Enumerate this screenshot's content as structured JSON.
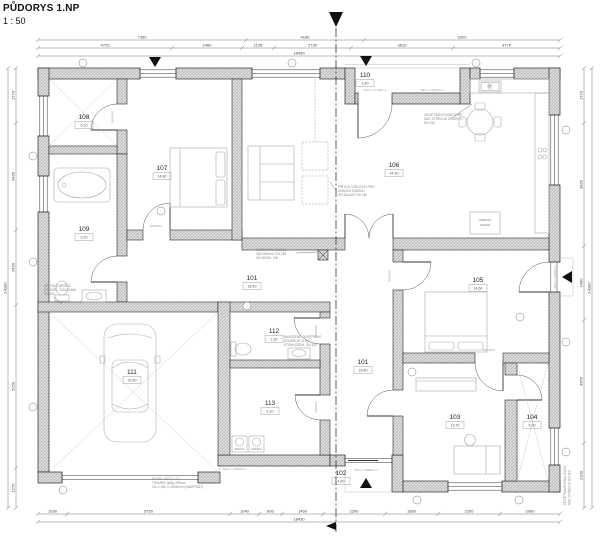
{
  "sheet": {
    "title": "PŮDORYS 1.NP",
    "scale": "1 : 50"
  },
  "rooms": [
    {
      "number": "101",
      "area": "18,40"
    },
    {
      "number": "102",
      "area": "4,60"
    },
    {
      "number": "103",
      "area": "13,70"
    },
    {
      "number": "104",
      "area": "4,20"
    },
    {
      "number": "105",
      "area": "14,60"
    },
    {
      "number": "106",
      "area": "44,30"
    },
    {
      "number": "107",
      "area": "14,80"
    },
    {
      "number": "108",
      "area": "5,10"
    },
    {
      "number": "109",
      "area": "9,20"
    },
    {
      "number": "110",
      "area": "3,40"
    },
    {
      "number": "111",
      "area": "22,60"
    },
    {
      "number": "112",
      "area": "2,30"
    },
    {
      "number": "113",
      "area": "6,10"
    }
  ],
  "appliances": {
    "fridge_line1": "AMERICKÁ",
    "fridge_line2": "LEDNICE",
    "washer": "PRAČKA",
    "dryer": "SUŠIČKA"
  },
  "notes": {
    "hood": [
      "ODVĚTRÁNÍ DIGESTOŘE",
      "NAD STŘECHU OBJEKTU",
      "DN 150"
    ],
    "stove_air": [
      "PŘÍVOD VZDUCHU PRO",
      "KRBOVÁ KAMNA /",
      "INSTALACE DN 150"
    ],
    "chimney": [
      "KOMÍNOVÉ TĚLESO",
      "360x360mm, DN 180",
      "SCHIEDEL UNI"
    ],
    "bath_vent": [
      "NAVRŽENÉ ODVĚTRÁNÍ",
      "KOUPELNY A WC",
      "PODHLEDEM, DN 100"
    ],
    "garage_vent": [
      "VĚTRACÍ MŘÍŽKA",
      "GARÁŽE - NASÁVÁNÍ",
      "DN 100"
    ],
    "garage_lintel": [
      "DETAIL VIZ D.1.1.2",
      "TRÁMEK výšky 250mm",
      "2xL č.180, L=5000mm (NADPRAŽÍ)"
    ],
    "sewer_vent": [
      "ODVĚTRÁNÍ KANALIZACE",
      "NAD STŘECHU DN 110"
    ]
  },
  "lintels": {
    "porch_door": "S4/4, L=1700mm",
    "kitchen_window": "S4/4, L=2600mm",
    "garage_rear": "2x S4/3, L=1500mm",
    "entry_door": "S4/4, L=2500mm",
    "terrace_door": "S4/4, L=2500mm"
  },
  "door_sizes": {
    "d108": "800/1970",
    "d107": "800/1970",
    "d112": "700/1970",
    "d113": "700/1970",
    "d105": "900/1970",
    "d103": "800/1970"
  },
  "dims": {
    "top1": [
      "7350",
      "4160",
      "6920"
    ],
    "top2": [
      "4725",
      "2460",
      "1135",
      "2730",
      "3610",
      "3770"
    ],
    "top3": [
      "18430"
    ],
    "bottom1": [
      "1030",
      "5750",
      "1040",
      "800",
      "1460",
      "2200",
      "1860",
      "2200",
      "2090"
    ],
    "bottom2": [
      "18430"
    ],
    "left1": [
      "1770",
      "3460",
      "2430",
      "5250",
      "1270"
    ],
    "left2": [
      "14180"
    ],
    "right1": [
      "1770",
      "3960",
      "2400",
      "3950",
      "2100"
    ],
    "right2": [
      "14180"
    ]
  }
}
